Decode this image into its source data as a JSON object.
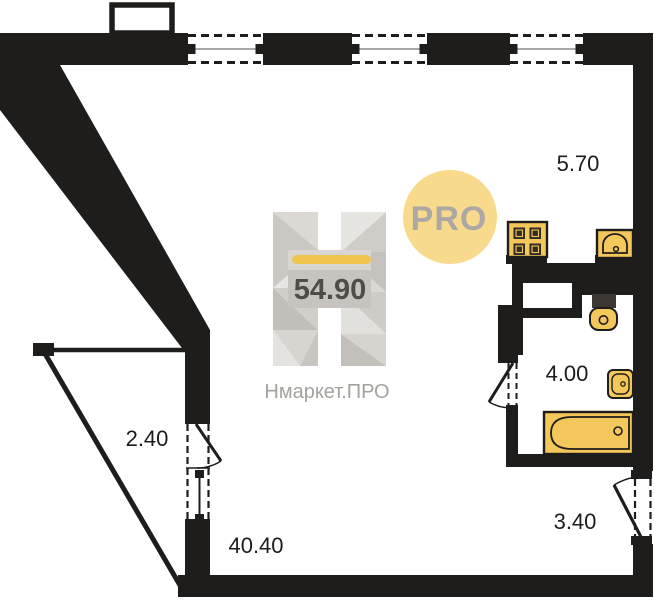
{
  "labels": {
    "kitchen": "5.70",
    "bathroom": "4.00",
    "hallway": "3.40",
    "balcony": "2.40",
    "room": "40.40"
  },
  "watermark": {
    "total_area": "54.90",
    "brand": "Нмаркет.ПРО",
    "badge": "PRO"
  },
  "colors": {
    "wall": "#1F1D1B",
    "fixture": "#F3C75A",
    "fixture_dark": "#3B3834",
    "accent_bar": "#EFC54F",
    "badge_bg": "#F8DA8C",
    "badge_text": "#ACA9A4",
    "area_text": "#504C47",
    "brand_text": "#A5A29E",
    "dim_text": "#1C1C1C",
    "window_line": "#8C8C8C"
  }
}
